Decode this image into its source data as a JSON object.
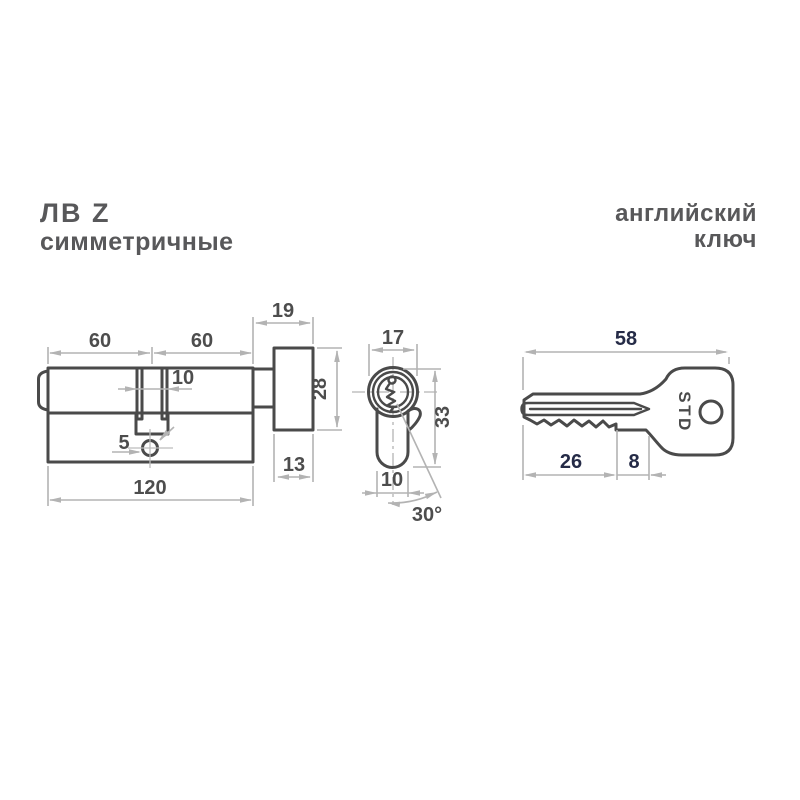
{
  "header": {
    "series_title": "ЛВ Z",
    "series_subtitle": "симметричные",
    "key_type_line1": "английский",
    "key_type_line2": "ключ"
  },
  "side_view": {
    "dim_left_half": "60",
    "dim_right_half": "60",
    "dim_knob_total": "19",
    "dim_cam_slot": "10",
    "dim_knob_height": "28",
    "dim_screw_hole": "5",
    "dim_knob_depth": "13",
    "dim_total_length": "120"
  },
  "front_view": {
    "dim_barrel_width": "17",
    "dim_total_height": "33",
    "dim_body_width": "10",
    "dim_cam_angle": "30°"
  },
  "key_view": {
    "brand_stamp": "STD",
    "dim_total_length": "58",
    "dim_blade_length": "26",
    "dim_shoulder": "8"
  },
  "colors": {
    "outline": "#4a4a4a",
    "dimension_lines": "#b3b3b3",
    "dimension_text": "#4d4d4d",
    "key_dimension_text": "#252b47",
    "heading_text": "#58585a",
    "background": "#ffffff"
  }
}
